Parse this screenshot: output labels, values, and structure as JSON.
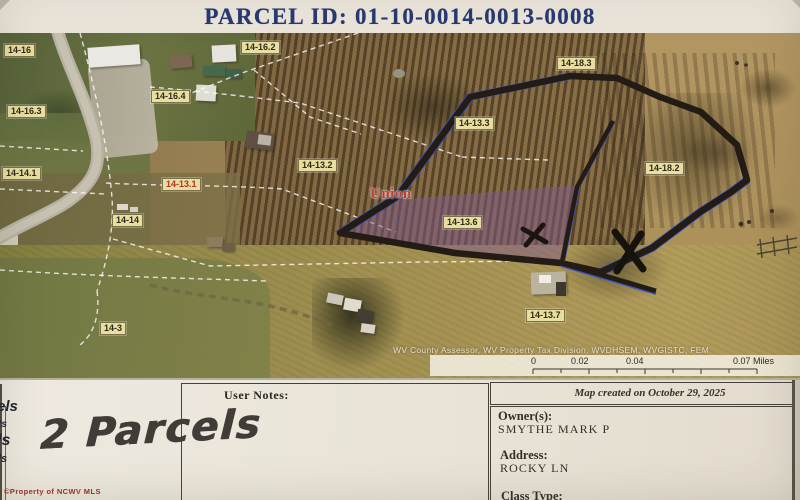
{
  "header": {
    "title": "PARCEL ID: 01-10-0014-0013-0008"
  },
  "map": {
    "region_label": "Union",
    "attribution": "WV County Assessor, WV Property Tax Division, WVDHSEM, WVGISTC, FEM",
    "scale": {
      "t0": "0",
      "t1": "0.02",
      "t2": "0.04",
      "t3": "0.07 Miles"
    },
    "labels": [
      {
        "text": "14-16"
      },
      {
        "text": "14-16.2"
      },
      {
        "text": "14-16.4"
      },
      {
        "text": "14-16.3"
      },
      {
        "text": "14-14.1"
      },
      {
        "text": "14-13.2"
      },
      {
        "text": "14-13.1"
      },
      {
        "text": "14-14"
      },
      {
        "text": "14-13.3"
      },
      {
        "text": "14-18.3"
      },
      {
        "text": "14-18.2"
      },
      {
        "text": "14-13.6"
      },
      {
        "text": "14-13.7"
      },
      {
        "text": "14-3"
      }
    ],
    "colors": {
      "boundary_blue": "#3d52c4",
      "highlight_purple": "#7e5a8c",
      "label_bg": "#e8de9e",
      "header_blue": "#263974"
    }
  },
  "notes": {
    "label": "User Notes:",
    "handwritten": "2 Parcels"
  },
  "edge_fragments": [
    "els",
    "ts",
    "ls",
    "ls"
  ],
  "info": {
    "map_created": "Map created on October 29, 2025",
    "owner_label": "Owner(s):",
    "owner": "SMYTHE MARK P",
    "address_label": "Address:",
    "address": "ROCKY LN",
    "class_label": "Class Type:"
  },
  "copyright": "©Property of NCWV MLS"
}
